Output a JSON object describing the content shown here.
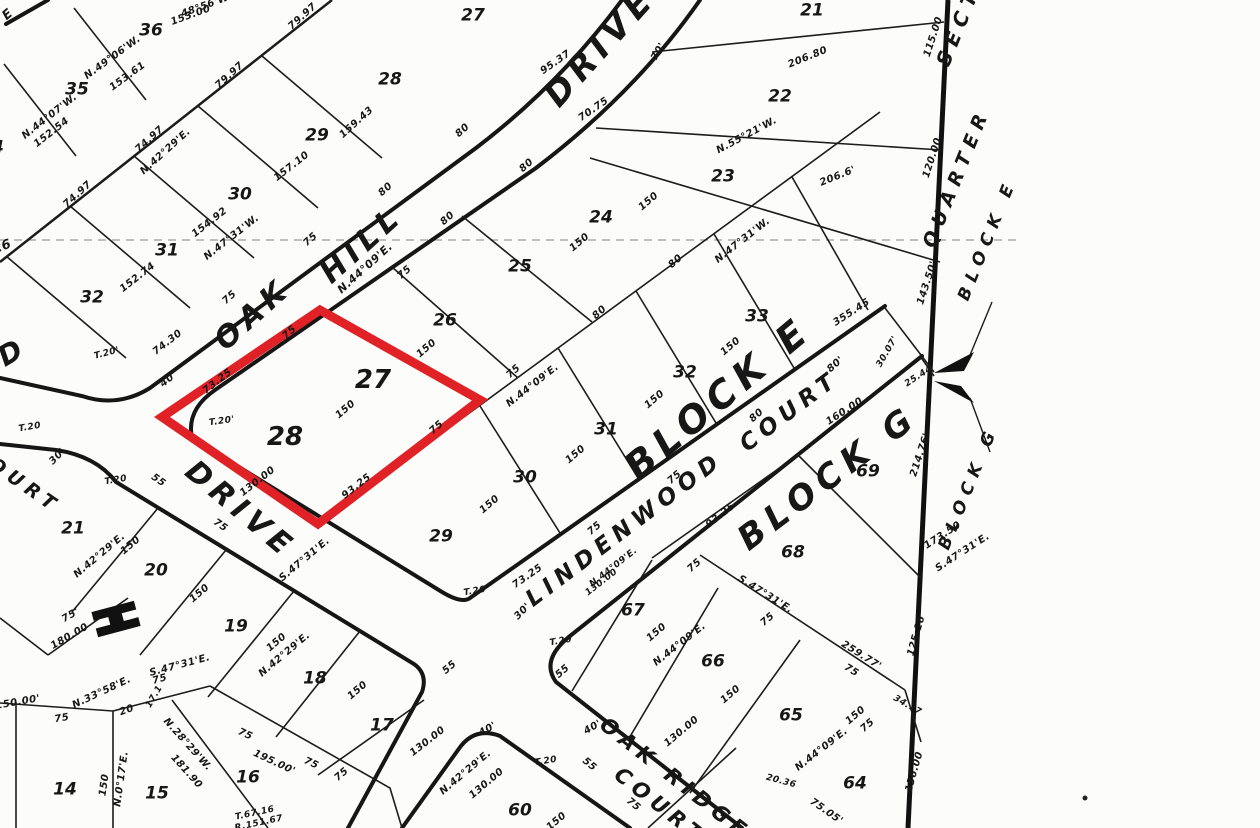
{
  "map": {
    "type": "plat-survey-map",
    "paper_color": "#fcfcfa",
    "ink_color": "#171717",
    "highlight": {
      "lots": [
        "27",
        "28"
      ],
      "block": "BLOCK E",
      "color": "#e02227"
    },
    "streets": [
      "O A K   H I L L   D R I V E",
      "D R I V E",
      "LINDENWOOD COURT",
      "OAK RIDGE COURT",
      "COURT"
    ],
    "blocks": [
      "BLOCK E",
      "BLOCK G",
      "QUARTER SECTION"
    ],
    "lots_block_e": [
      "21",
      "22",
      "23",
      "24",
      "25",
      "26",
      "27",
      "28",
      "29",
      "30",
      "31",
      "32",
      "33"
    ],
    "lots_northwest": [
      "36",
      "35",
      "34",
      "28",
      "29",
      "30",
      "31",
      "32",
      "27"
    ],
    "lots_southwest": [
      "21",
      "20",
      "19",
      "18",
      "17",
      "16",
      "15",
      "14"
    ],
    "lots_block_g": [
      "69",
      "68",
      "67",
      "66",
      "65",
      "64",
      "60"
    ]
  },
  "annotations": [
    {
      "t": "OAK",
      "x": 253,
      "y": 315,
      "r": -42,
      "s": 30,
      "c": "street",
      "n": "street-name-oak-hill"
    },
    {
      "t": "HILL",
      "x": 362,
      "y": 245,
      "r": -42,
      "s": 30,
      "c": "street",
      "n": "street-name-oak-hill"
    },
    {
      "t": "DRIVE",
      "x": 600,
      "y": 47,
      "r": -48,
      "s": 34,
      "c": "street",
      "n": "street-name-drive-top"
    },
    {
      "t": "DRIVE",
      "x": 240,
      "y": 510,
      "r": 40,
      "s": 30,
      "c": "street",
      "n": "street-name-drive-lower"
    },
    {
      "t": "LINDENWOOD",
      "x": 625,
      "y": 530,
      "r": -37,
      "s": 23,
      "c": "street",
      "n": "street-name-lindenwood"
    },
    {
      "t": "COURT",
      "x": 790,
      "y": 412,
      "r": -37,
      "s": 23,
      "c": "street",
      "n": "street-name-lindenwood-court"
    },
    {
      "t": "OAK RIDGE",
      "x": 675,
      "y": 779,
      "r": 38,
      "s": 21,
      "c": "street",
      "n": "street-name-oak-ridge"
    },
    {
      "t": "COURT",
      "x": 660,
      "y": 806,
      "r": 38,
      "s": 21,
      "c": "street",
      "n": "street-name-oak-ridge-court"
    },
    {
      "t": "COURT",
      "x": 16,
      "y": 480,
      "r": 35,
      "s": 19,
      "c": "street",
      "n": "street-name-west-court"
    },
    {
      "t": "D",
      "x": 13,
      "y": 352,
      "r": -30,
      "s": 28,
      "c": "street",
      "n": "street-name-fragment"
    },
    {
      "t": "E",
      "x": 10,
      "y": 13,
      "r": -40,
      "s": 13,
      "c": "street",
      "n": "street-name-fragment"
    },
    {
      "t": "BLOCK E",
      "x": 718,
      "y": 398,
      "r": -40,
      "s": 38,
      "c": "block",
      "n": "block-e-label"
    },
    {
      "t": "BLOCK G",
      "x": 828,
      "y": 478,
      "r": -37,
      "s": 34,
      "c": "block",
      "n": "block-g-label"
    },
    {
      "t": "SECT",
      "x": 958,
      "y": 26,
      "r": -68,
      "s": 20,
      "c": "block",
      "n": "quarter-section-label"
    },
    {
      "t": "QUARTER",
      "x": 957,
      "y": 178,
      "r": -68,
      "s": 19,
      "c": "block",
      "n": "quarter-section-label"
    },
    {
      "t": "BLOCK E",
      "x": 988,
      "y": 240,
      "r": -68,
      "s": 17,
      "c": "block",
      "n": "block-e-pointer-label"
    },
    {
      "t": "BLOCK G",
      "x": 969,
      "y": 488,
      "r": -68,
      "s": 17,
      "c": "block",
      "n": "block-g-pointer-label"
    },
    {
      "t": "36",
      "x": 151,
      "y": 31,
      "c": "lot"
    },
    {
      "t": "35",
      "x": 77,
      "y": 90,
      "c": "lot"
    },
    {
      "t": "34",
      "x": -8,
      "y": 148,
      "c": "lot"
    },
    {
      "t": "28",
      "x": 390,
      "y": 80,
      "c": "lot"
    },
    {
      "t": "29",
      "x": 317,
      "y": 136,
      "c": "lot"
    },
    {
      "t": "30",
      "x": 240,
      "y": 195,
      "c": "lot"
    },
    {
      "t": "31",
      "x": 167,
      "y": 251,
      "c": "lot"
    },
    {
      "t": "32",
      "x": 92,
      "y": 298,
      "c": "lot"
    },
    {
      "t": "26",
      "x": 2,
      "y": 247,
      "r": -20,
      "s": 13,
      "c": "lot"
    },
    {
      "t": "27",
      "x": 473,
      "y": 16,
      "c": "lot"
    },
    {
      "t": "21",
      "x": 812,
      "y": 11,
      "c": "lot"
    },
    {
      "t": "22",
      "x": 780,
      "y": 97,
      "c": "lot"
    },
    {
      "t": "23",
      "x": 723,
      "y": 177,
      "c": "lot"
    },
    {
      "t": "24",
      "x": 601,
      "y": 218,
      "c": "lot"
    },
    {
      "t": "25",
      "x": 520,
      "y": 267,
      "c": "lot"
    },
    {
      "t": "26",
      "x": 445,
      "y": 321,
      "c": "lot"
    },
    {
      "t": "27",
      "x": 373,
      "y": 380,
      "c": "lotbig",
      "n": "highlighted-lot-number"
    },
    {
      "t": "28",
      "x": 285,
      "y": 437,
      "c": "lotbig",
      "n": "highlighted-lot-number"
    },
    {
      "t": "29",
      "x": 441,
      "y": 537,
      "c": "lot"
    },
    {
      "t": "30",
      "x": 525,
      "y": 478,
      "c": "lot"
    },
    {
      "t": "31",
      "x": 606,
      "y": 430,
      "c": "lot"
    },
    {
      "t": "32",
      "x": 685,
      "y": 373,
      "c": "lot"
    },
    {
      "t": "33",
      "x": 757,
      "y": 317,
      "c": "lot"
    },
    {
      "t": "21",
      "x": 73,
      "y": 529,
      "c": "lot"
    },
    {
      "t": "20",
      "x": 156,
      "y": 571,
      "c": "lot"
    },
    {
      "t": "19",
      "x": 236,
      "y": 627,
      "c": "lot"
    },
    {
      "t": "18",
      "x": 315,
      "y": 679,
      "c": "lot"
    },
    {
      "t": "17",
      "x": 382,
      "y": 726,
      "c": "lot"
    },
    {
      "t": "14",
      "x": 65,
      "y": 790,
      "c": "lot"
    },
    {
      "t": "15",
      "x": 157,
      "y": 794,
      "c": "lot"
    },
    {
      "t": "16",
      "x": 248,
      "y": 778,
      "c": "lot"
    },
    {
      "t": "69",
      "x": 868,
      "y": 472,
      "c": "lot"
    },
    {
      "t": "68",
      "x": 793,
      "y": 553,
      "c": "lot"
    },
    {
      "t": "67",
      "x": 633,
      "y": 611,
      "c": "lot"
    },
    {
      "t": "66",
      "x": 713,
      "y": 662,
      "c": "lot"
    },
    {
      "t": "65",
      "x": 791,
      "y": 716,
      "c": "lot"
    },
    {
      "t": "64",
      "x": 855,
      "y": 784,
      "c": "lot"
    },
    {
      "t": "60",
      "x": 520,
      "y": 811,
      "c": "lot"
    },
    {
      "t": "48°56'W.",
      "x": 207,
      "y": 6,
      "r": -20,
      "c": "meas"
    },
    {
      "t": "153.00",
      "x": 191,
      "y": 16,
      "r": -20,
      "c": "meas"
    },
    {
      "t": "79.97",
      "x": 303,
      "y": 17,
      "r": -42,
      "c": "meas"
    },
    {
      "t": "79.97",
      "x": 230,
      "y": 76,
      "r": -42,
      "c": "meas"
    },
    {
      "t": "N.49°06'W.",
      "x": 113,
      "y": 58,
      "r": -36,
      "c": "meas"
    },
    {
      "t": "153.61",
      "x": 128,
      "y": 77,
      "r": -36,
      "c": "meas"
    },
    {
      "t": "74.97",
      "x": 150,
      "y": 140,
      "r": -42,
      "c": "meas"
    },
    {
      "t": "N.42°29'E.",
      "x": 166,
      "y": 152,
      "r": -42,
      "c": "meas"
    },
    {
      "t": "74.97",
      "x": 78,
      "y": 195,
      "r": -42,
      "c": "meas"
    },
    {
      "t": "N.44°07'W.",
      "x": 50,
      "y": 117,
      "r": -38,
      "c": "meas"
    },
    {
      "t": "152.54",
      "x": 52,
      "y": 133,
      "r": -38,
      "c": "meas"
    },
    {
      "t": "159.43",
      "x": 357,
      "y": 123,
      "r": -42,
      "c": "meas"
    },
    {
      "t": "157.10",
      "x": 292,
      "y": 167,
      "r": -38,
      "c": "meas"
    },
    {
      "t": "154.92",
      "x": 210,
      "y": 223,
      "r": -38,
      "c": "meas"
    },
    {
      "t": "N.47°31'W.",
      "x": 232,
      "y": 238,
      "r": -38,
      "c": "meas"
    },
    {
      "t": "152.74",
      "x": 138,
      "y": 278,
      "r": -38,
      "c": "meas"
    },
    {
      "t": "75",
      "x": 311,
      "y": 240,
      "r": -42,
      "c": "meas"
    },
    {
      "t": "75",
      "x": 230,
      "y": 298,
      "r": -42,
      "c": "meas"
    },
    {
      "t": "75",
      "x": 405,
      "y": 273,
      "r": -42,
      "c": "meas"
    },
    {
      "t": "80",
      "x": 386,
      "y": 190,
      "r": -42,
      "c": "meas"
    },
    {
      "t": "80",
      "x": 448,
      "y": 219,
      "r": -42,
      "c": "meas"
    },
    {
      "t": "80",
      "x": 463,
      "y": 131,
      "r": -42,
      "c": "meas"
    },
    {
      "t": "80",
      "x": 527,
      "y": 166,
      "r": -42,
      "c": "meas"
    },
    {
      "t": "95.37",
      "x": 556,
      "y": 63,
      "r": -35,
      "c": "meas"
    },
    {
      "t": "70'",
      "x": 659,
      "y": 52,
      "r": -60,
      "c": "meas"
    },
    {
      "t": "70.75",
      "x": 594,
      "y": 110,
      "r": -35,
      "c": "meas"
    },
    {
      "t": "206.80",
      "x": 808,
      "y": 58,
      "r": -22,
      "c": "meas"
    },
    {
      "t": "N.55°21'W.",
      "x": 747,
      "y": 136,
      "r": -28,
      "c": "meas"
    },
    {
      "t": "206.6'",
      "x": 838,
      "y": 177,
      "r": -22,
      "c": "meas"
    },
    {
      "t": "150",
      "x": 649,
      "y": 202,
      "r": -40,
      "c": "meas"
    },
    {
      "t": "150",
      "x": 580,
      "y": 243,
      "r": -40,
      "c": "meas"
    },
    {
      "t": "N.47°31'W.",
      "x": 743,
      "y": 241,
      "r": -38,
      "c": "meas"
    },
    {
      "t": "80",
      "x": 676,
      "y": 262,
      "r": -42,
      "c": "meas"
    },
    {
      "t": "N.44°09'E.",
      "x": 365,
      "y": 268,
      "r": -42,
      "s": 11,
      "c": "meas"
    },
    {
      "t": "75",
      "x": 290,
      "y": 333,
      "r": -42,
      "c": "meas"
    },
    {
      "t": "74.30",
      "x": 168,
      "y": 343,
      "r": -38,
      "c": "meas"
    },
    {
      "t": "40'",
      "x": 169,
      "y": 380,
      "r": -38,
      "c": "meas"
    },
    {
      "t": "T.20'",
      "x": 107,
      "y": 354,
      "r": -15,
      "s": 9,
      "c": "meas"
    },
    {
      "t": "73.25",
      "x": 218,
      "y": 382,
      "r": -38,
      "c": "meas"
    },
    {
      "t": "T.20",
      "x": 30,
      "y": 428,
      "r": -10,
      "s": 9,
      "c": "meas"
    },
    {
      "t": "T.20'",
      "x": 222,
      "y": 422,
      "r": -8,
      "s": 9,
      "c": "meas"
    },
    {
      "t": "30'",
      "x": 58,
      "y": 457,
      "r": -45,
      "c": "meas"
    },
    {
      "t": "T.20",
      "x": 116,
      "y": 481,
      "r": -10,
      "s": 9,
      "c": "meas"
    },
    {
      "t": "55",
      "x": 158,
      "y": 481,
      "r": 35,
      "c": "meas"
    },
    {
      "t": "75",
      "x": 220,
      "y": 526,
      "r": 35,
      "c": "meas"
    },
    {
      "t": "150",
      "x": 427,
      "y": 349,
      "r": -40,
      "c": "meas"
    },
    {
      "t": "150",
      "x": 346,
      "y": 410,
      "r": -40,
      "c": "meas"
    },
    {
      "t": "75",
      "x": 437,
      "y": 428,
      "r": -42,
      "c": "meas"
    },
    {
      "t": "75",
      "x": 514,
      "y": 372,
      "r": -42,
      "c": "meas"
    },
    {
      "t": "N.44°09'E.",
      "x": 533,
      "y": 386,
      "r": -38,
      "c": "meas"
    },
    {
      "t": "93.25",
      "x": 357,
      "y": 487,
      "r": -38,
      "c": "meas"
    },
    {
      "t": "130.00",
      "x": 258,
      "y": 482,
      "r": -38,
      "c": "meas"
    },
    {
      "t": "355.45",
      "x": 852,
      "y": 313,
      "r": -33,
      "c": "meas"
    },
    {
      "t": "143.50'",
      "x": 928,
      "y": 283,
      "r": -72,
      "c": "meas"
    },
    {
      "t": "115.00",
      "x": 934,
      "y": 37,
      "r": -72,
      "c": "meas"
    },
    {
      "t": "120.00",
      "x": 933,
      "y": 158,
      "r": -72,
      "c": "meas"
    },
    {
      "t": "30.07'",
      "x": 888,
      "y": 352,
      "r": -60,
      "s": 9,
      "c": "meas"
    },
    {
      "t": "25.44",
      "x": 919,
      "y": 377,
      "r": -33,
      "s": 9,
      "c": "meas"
    },
    {
      "t": "80'",
      "x": 836,
      "y": 365,
      "r": -42,
      "c": "meas"
    },
    {
      "t": "80",
      "x": 600,
      "y": 313,
      "r": -42,
      "c": "meas"
    },
    {
      "t": "80",
      "x": 757,
      "y": 416,
      "r": -42,
      "c": "meas"
    },
    {
      "t": "150",
      "x": 731,
      "y": 347,
      "r": -40,
      "c": "meas"
    },
    {
      "t": "150",
      "x": 655,
      "y": 400,
      "r": -40,
      "c": "meas"
    },
    {
      "t": "150",
      "x": 576,
      "y": 455,
      "r": -40,
      "c": "meas"
    },
    {
      "t": "150",
      "x": 490,
      "y": 505,
      "r": -40,
      "c": "meas"
    },
    {
      "t": "160.00",
      "x": 845,
      "y": 412,
      "r": -33,
      "c": "meas"
    },
    {
      "t": "214.76'",
      "x": 921,
      "y": 455,
      "r": -72,
      "c": "meas"
    },
    {
      "t": "173.50",
      "x": 943,
      "y": 536,
      "r": -33,
      "c": "meas"
    },
    {
      "t": "S.47°31'E.",
      "x": 963,
      "y": 553,
      "r": -33,
      "c": "meas"
    },
    {
      "t": "75",
      "x": 675,
      "y": 478,
      "r": -40,
      "c": "meas"
    },
    {
      "t": "75",
      "x": 595,
      "y": 529,
      "r": -40,
      "c": "meas"
    },
    {
      "t": "93.25",
      "x": 721,
      "y": 516,
      "r": -38,
      "c": "meas"
    },
    {
      "t": "73.25",
      "x": 528,
      "y": 577,
      "r": -35,
      "c": "meas"
    },
    {
      "t": "S.47°31'E.",
      "x": 305,
      "y": 560,
      "r": -40,
      "c": "meas"
    },
    {
      "t": "130.00",
      "x": 428,
      "y": 742,
      "r": -38,
      "c": "meas"
    },
    {
      "t": "150",
      "x": 358,
      "y": 691,
      "r": -40,
      "c": "meas"
    },
    {
      "t": "55",
      "x": 450,
      "y": 668,
      "r": -40,
      "c": "meas"
    },
    {
      "t": "75",
      "x": 342,
      "y": 775,
      "r": -40,
      "c": "meas"
    },
    {
      "t": "T.20",
      "x": 475,
      "y": 592,
      "r": -10,
      "s": 9,
      "c": "meas"
    },
    {
      "t": "30'",
      "x": 523,
      "y": 612,
      "r": -45,
      "c": "meas"
    },
    {
      "t": "T.20",
      "x": 561,
      "y": 642,
      "r": -10,
      "s": 9,
      "c": "meas"
    },
    {
      "t": "55",
      "x": 563,
      "y": 672,
      "r": -40,
      "c": "meas"
    },
    {
      "t": "N.44°09'E.",
      "x": 614,
      "y": 568,
      "r": -38,
      "s": 9,
      "c": "meas"
    },
    {
      "t": "130.00",
      "x": 602,
      "y": 583,
      "r": -38,
      "s": 9,
      "c": "meas"
    },
    {
      "t": "40'",
      "x": 488,
      "y": 730,
      "r": -30,
      "c": "meas"
    },
    {
      "t": "T.20",
      "x": 546,
      "y": 762,
      "r": -10,
      "s": 9,
      "c": "meas"
    },
    {
      "t": "40'",
      "x": 593,
      "y": 728,
      "r": -30,
      "c": "meas"
    },
    {
      "t": "55",
      "x": 589,
      "y": 765,
      "r": 40,
      "c": "meas"
    },
    {
      "t": "75",
      "x": 633,
      "y": 805,
      "r": 40,
      "c": "meas"
    },
    {
      "t": "N.42°29'E.",
      "x": 466,
      "y": 773,
      "r": -40,
      "c": "meas"
    },
    {
      "t": "130.00",
      "x": 487,
      "y": 784,
      "r": -40,
      "c": "meas"
    },
    {
      "t": "150",
      "x": 557,
      "y": 822,
      "r": -40,
      "c": "meas"
    },
    {
      "t": "130.00",
      "x": 682,
      "y": 732,
      "r": -40,
      "c": "meas"
    },
    {
      "t": "150",
      "x": 657,
      "y": 633,
      "r": -40,
      "c": "meas"
    },
    {
      "t": "N.44°09'E.",
      "x": 680,
      "y": 645,
      "r": -38,
      "c": "meas"
    },
    {
      "t": "75",
      "x": 695,
      "y": 566,
      "r": -42,
      "c": "meas"
    },
    {
      "t": "75",
      "x": 768,
      "y": 620,
      "r": -40,
      "c": "meas"
    },
    {
      "t": "150",
      "x": 731,
      "y": 695,
      "r": -40,
      "c": "meas"
    },
    {
      "t": "S.47°31'E.",
      "x": 765,
      "y": 595,
      "r": 32,
      "c": "meas"
    },
    {
      "t": "259.77'",
      "x": 861,
      "y": 656,
      "r": 32,
      "c": "meas"
    },
    {
      "t": "75",
      "x": 851,
      "y": 671,
      "r": 32,
      "c": "meas"
    },
    {
      "t": "125.16",
      "x": 917,
      "y": 636,
      "r": -74,
      "c": "meas"
    },
    {
      "t": "34.77",
      "x": 907,
      "y": 706,
      "r": 30,
      "s": 9,
      "c": "meas"
    },
    {
      "t": "150",
      "x": 856,
      "y": 716,
      "r": -40,
      "c": "meas"
    },
    {
      "t": "N.44°09'E.",
      "x": 822,
      "y": 750,
      "r": -38,
      "c": "meas"
    },
    {
      "t": "20.36",
      "x": 781,
      "y": 782,
      "r": 15,
      "s": 9,
      "c": "meas"
    },
    {
      "t": "136.00",
      "x": 915,
      "y": 772,
      "r": -74,
      "c": "meas"
    },
    {
      "t": "75.05'",
      "x": 826,
      "y": 812,
      "r": 35,
      "c": "meas"
    },
    {
      "t": "75",
      "x": 868,
      "y": 726,
      "r": -40,
      "c": "meas"
    },
    {
      "t": "N.42°29'E.",
      "x": 100,
      "y": 556,
      "r": -40,
      "c": "meas"
    },
    {
      "t": "150",
      "x": 131,
      "y": 546,
      "r": -40,
      "c": "meas"
    },
    {
      "t": "150",
      "x": 200,
      "y": 594,
      "r": -40,
      "c": "meas"
    },
    {
      "t": "75'",
      "x": 71,
      "y": 616,
      "r": -30,
      "c": "meas"
    },
    {
      "t": "180.00",
      "x": 70,
      "y": 637,
      "r": -30,
      "c": "meas"
    },
    {
      "t": "150",
      "x": 277,
      "y": 643,
      "r": -40,
      "c": "meas"
    },
    {
      "t": "N.42°29'E.",
      "x": 285,
      "y": 655,
      "r": -40,
      "c": "meas"
    },
    {
      "t": "S.47°31'E.",
      "x": 180,
      "y": 666,
      "r": -15,
      "c": "meas"
    },
    {
      "t": "75",
      "x": 160,
      "y": 680,
      "r": -15,
      "c": "meas"
    },
    {
      "t": "N.33°58'E.",
      "x": 102,
      "y": 693,
      "r": -25,
      "c": "meas"
    },
    {
      "t": "20",
      "x": 127,
      "y": 711,
      "r": -20,
      "c": "meas"
    },
    {
      "t": "17.1",
      "x": 155,
      "y": 697,
      "r": -60,
      "s": 9,
      "c": "meas"
    },
    {
      "t": "150.00'",
      "x": 18,
      "y": 703,
      "r": -10,
      "c": "meas"
    },
    {
      "t": "75",
      "x": 62,
      "y": 719,
      "r": -10,
      "c": "meas"
    },
    {
      "t": "N.28°29'W.",
      "x": 187,
      "y": 745,
      "r": 48,
      "c": "meas"
    },
    {
      "t": "181.90",
      "x": 186,
      "y": 772,
      "r": 48,
      "c": "meas"
    },
    {
      "t": "N.0°17'E.",
      "x": 122,
      "y": 779,
      "r": -82,
      "c": "meas"
    },
    {
      "t": "150",
      "x": 105,
      "y": 785,
      "r": -82,
      "c": "meas"
    },
    {
      "t": "195.00'",
      "x": 274,
      "y": 763,
      "r": 25,
      "c": "meas"
    },
    {
      "t": "75",
      "x": 245,
      "y": 735,
      "r": 25,
      "c": "meas"
    },
    {
      "t": "75",
      "x": 311,
      "y": 764,
      "r": 25,
      "c": "meas"
    },
    {
      "t": "T.67.16",
      "x": 255,
      "y": 814,
      "r": -12,
      "s": 9,
      "c": "meas"
    },
    {
      "t": "R.151.67",
      "x": 259,
      "y": 824,
      "r": -12,
      "s": 9,
      "c": "meas"
    }
  ]
}
